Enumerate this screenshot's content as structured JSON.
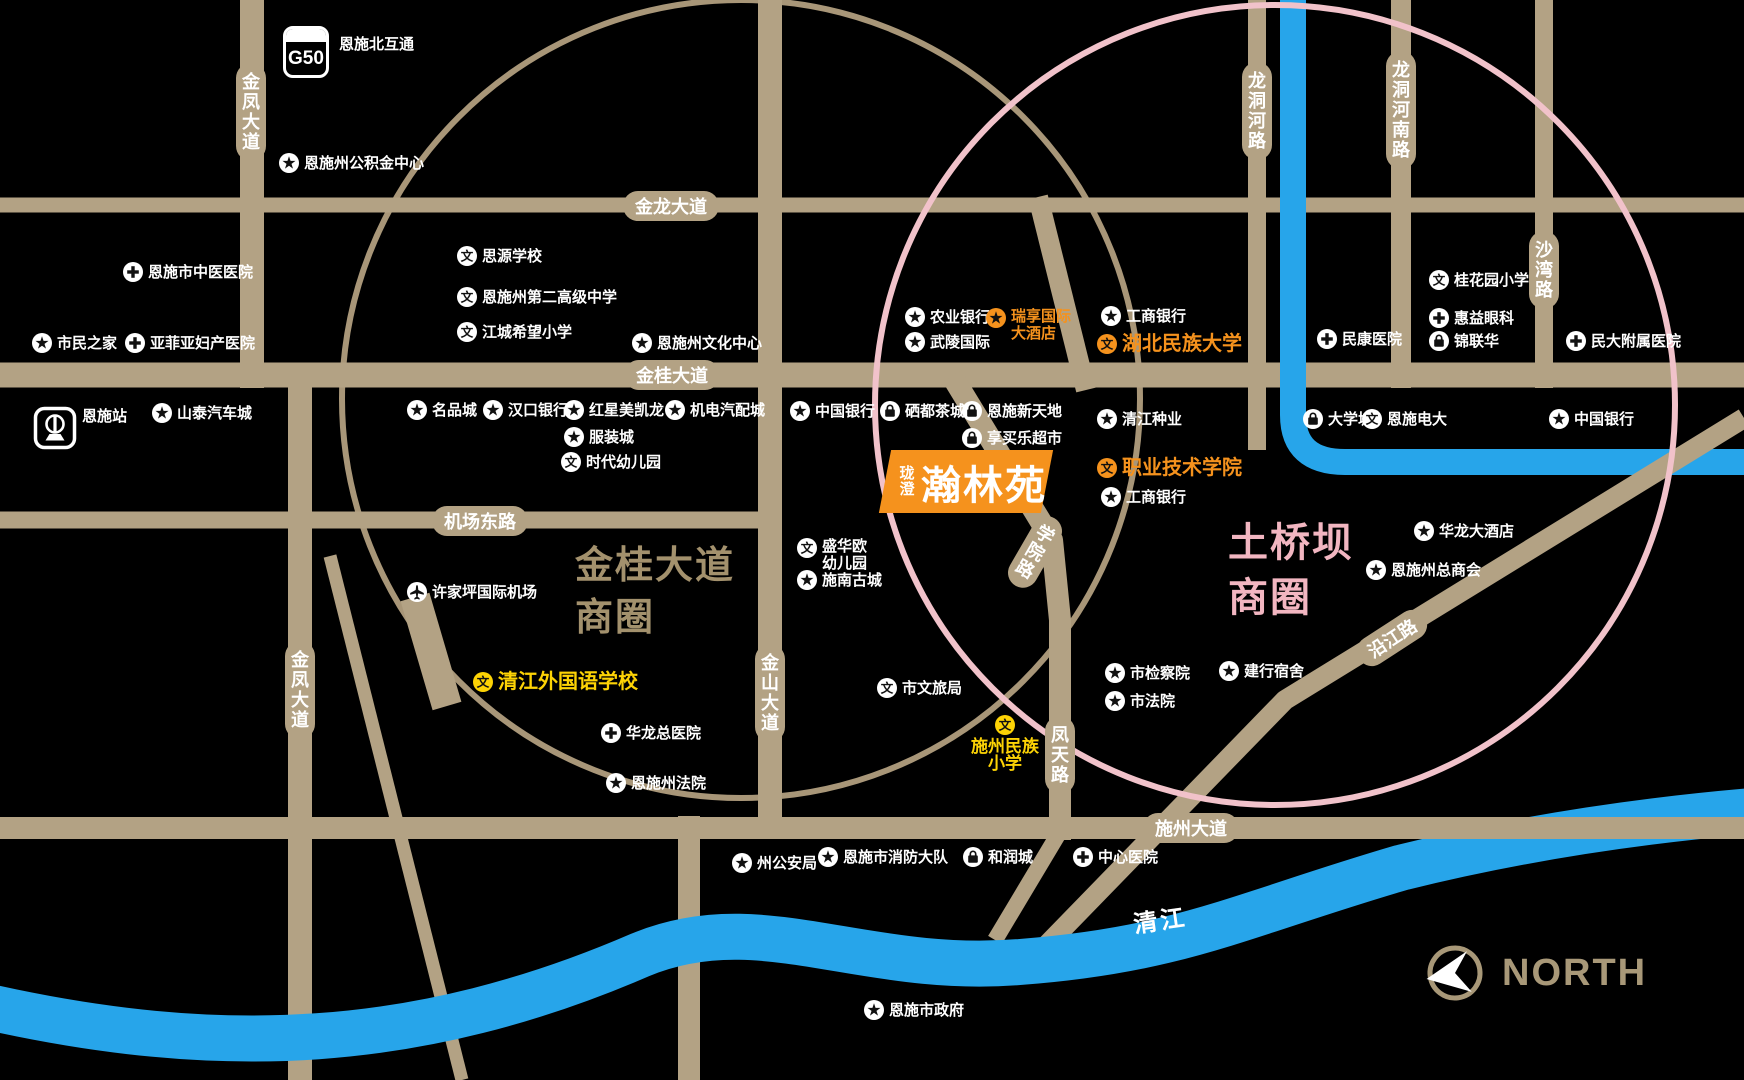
{
  "map": {
    "highway_badge": {
      "code": "G50",
      "label": "恩施北互通"
    },
    "compass": {
      "label": "NORTH"
    },
    "project": {
      "prefix": "珑澄",
      "name": "瀚林苑"
    },
    "river_label": "清江",
    "icons": {
      "school_glyph": "文"
    },
    "colors": {
      "road_tan": "#b3a284",
      "river_blue": "#27a5ea",
      "accent_orange": "#f5921d",
      "accent_yellow": "#fdd305",
      "circle_pink": "#f1c2ca",
      "circle_tan": "#a89678",
      "district_tan_text": "#a3916d",
      "district_pink_text": "#f2b6c1"
    },
    "districts": [
      {
        "lines": [
          "金桂大道",
          "商圈"
        ],
        "color": "#a3916d",
        "x": 575,
        "y": 540,
        "size": 38
      },
      {
        "lines": [
          "土桥坝",
          "商圈"
        ],
        "color": "#f2b6c1",
        "x": 1228,
        "y": 516,
        "size": 40
      }
    ],
    "road_labels": [
      {
        "text": "金龙大道",
        "x": 671,
        "y": 206,
        "dir": "h",
        "rot": 0
      },
      {
        "text": "金桂大道",
        "x": 672,
        "y": 375,
        "dir": "h",
        "rot": 0
      },
      {
        "text": "机场东路",
        "x": 480,
        "y": 521,
        "dir": "h",
        "rot": 0
      },
      {
        "text": "施州大道",
        "x": 1191,
        "y": 828,
        "dir": "h",
        "rot": 0
      },
      {
        "text": "金凤大道",
        "x": 251,
        "y": 112,
        "dir": "v",
        "rot": 0
      },
      {
        "text": "金凤大道",
        "x": 300,
        "y": 690,
        "dir": "v",
        "rot": 0
      },
      {
        "text": "金山大道",
        "x": 770,
        "y": 693,
        "dir": "v",
        "rot": 0
      },
      {
        "text": "龙洞河路",
        "x": 1257,
        "y": 111,
        "dir": "v",
        "rot": 0
      },
      {
        "text": "龙洞河南路",
        "x": 1401,
        "y": 110,
        "dir": "v",
        "rot": 0
      },
      {
        "text": "沙湾路",
        "x": 1544,
        "y": 270,
        "dir": "v",
        "rot": 0
      },
      {
        "text": "凤天路",
        "x": 1060,
        "y": 755,
        "dir": "v",
        "rot": 0
      },
      {
        "text": "学院路",
        "x": 1035,
        "y": 552,
        "dir": "v",
        "rot": 30
      },
      {
        "text": "沿江路",
        "x": 1392,
        "y": 638,
        "dir": "h",
        "rot": -33
      }
    ],
    "pois": [
      {
        "label": "恩施州公积金中心",
        "x": 289,
        "y": 163,
        "icon": "star",
        "tone": "white"
      },
      {
        "label": "恩施市中医医院",
        "x": 133,
        "y": 272,
        "icon": "hospital",
        "tone": "white"
      },
      {
        "label": "市民之家",
        "x": 42,
        "y": 343,
        "icon": "star",
        "tone": "white"
      },
      {
        "label": "亚菲亚妇产医院",
        "x": 135,
        "y": 343,
        "icon": "hospital",
        "tone": "white"
      },
      {
        "label": "恩施站",
        "x": 55,
        "y": 428,
        "icon": "train",
        "tone": "white",
        "variant": "train"
      },
      {
        "label": "山泰汽车城",
        "x": 162,
        "y": 413,
        "icon": "star",
        "tone": "white"
      },
      {
        "label": "思源学校",
        "x": 467,
        "y": 256,
        "icon": "school",
        "tone": "white"
      },
      {
        "label": "恩施州第二高级中学",
        "x": 467,
        "y": 297,
        "icon": "school",
        "tone": "white"
      },
      {
        "label": "江城希望小学",
        "x": 467,
        "y": 332,
        "icon": "school",
        "tone": "white"
      },
      {
        "label": "恩施州文化中心",
        "x": 642,
        "y": 343,
        "icon": "star",
        "tone": "white"
      },
      {
        "label": "名品城",
        "x": 417,
        "y": 410,
        "icon": "star",
        "tone": "white"
      },
      {
        "label": "汉口银行",
        "x": 493,
        "y": 410,
        "icon": "star",
        "tone": "white"
      },
      {
        "label": "红星美凯龙",
        "x": 574,
        "y": 410,
        "icon": "star",
        "tone": "white"
      },
      {
        "label": "机电汽配城",
        "x": 675,
        "y": 410,
        "icon": "star",
        "tone": "white"
      },
      {
        "label": "服装城",
        "x": 574,
        "y": 437,
        "icon": "star",
        "tone": "white"
      },
      {
        "label": "时代幼儿园",
        "x": 571,
        "y": 462,
        "icon": "school",
        "tone": "white"
      },
      {
        "label": "中国银行",
        "x": 800,
        "y": 411,
        "icon": "star",
        "tone": "white"
      },
      {
        "label": "硒都茶城",
        "x": 890,
        "y": 411,
        "icon": "bag",
        "tone": "white"
      },
      {
        "label": "恩施新天地",
        "x": 972,
        "y": 411,
        "icon": "bag",
        "tone": "white"
      },
      {
        "label": "享买乐超市",
        "x": 972,
        "y": 438,
        "icon": "bag",
        "tone": "white"
      },
      {
        "label": "农业银行",
        "x": 915,
        "y": 317,
        "icon": "star",
        "tone": "white"
      },
      {
        "label": "武陵国际",
        "x": 915,
        "y": 342,
        "icon": "star",
        "tone": "white"
      },
      {
        "label": "瑞享国际大酒店",
        "x": 996,
        "y": 318,
        "icon": "star",
        "tone": "orange",
        "lines": [
          "瑞享国际",
          "大酒店"
        ]
      },
      {
        "label": "工商银行",
        "x": 1111,
        "y": 316,
        "icon": "star",
        "tone": "white"
      },
      {
        "label": "湖北民族大学",
        "x": 1107,
        "y": 344,
        "icon": "school",
        "tone": "orange",
        "size": 20
      },
      {
        "label": "清江种业",
        "x": 1107,
        "y": 419,
        "icon": "star",
        "tone": "white"
      },
      {
        "label": "职业技术学院",
        "x": 1107,
        "y": 468,
        "icon": "school",
        "tone": "orange",
        "size": 20
      },
      {
        "label": "工商银行",
        "x": 1111,
        "y": 497,
        "icon": "star",
        "tone": "white"
      },
      {
        "label": "民康医院",
        "x": 1327,
        "y": 339,
        "icon": "hospital",
        "tone": "white"
      },
      {
        "label": "桂花园小学",
        "x": 1439,
        "y": 280,
        "icon": "school",
        "tone": "white"
      },
      {
        "label": "惠益眼科",
        "x": 1439,
        "y": 318,
        "icon": "hospital",
        "tone": "white"
      },
      {
        "label": "锦联华",
        "x": 1439,
        "y": 341,
        "icon": "bag",
        "tone": "white"
      },
      {
        "label": "民大附属医院",
        "x": 1576,
        "y": 341,
        "icon": "hospital",
        "tone": "white"
      },
      {
        "label": "大学城",
        "x": 1313,
        "y": 419,
        "icon": "bag",
        "tone": "white"
      },
      {
        "label": "恩施电大",
        "x": 1372,
        "y": 419,
        "icon": "school",
        "tone": "white"
      },
      {
        "label": "中国银行",
        "x": 1559,
        "y": 419,
        "icon": "star",
        "tone": "white"
      },
      {
        "label": "华龙大酒店",
        "x": 1424,
        "y": 531,
        "icon": "star",
        "tone": "white"
      },
      {
        "label": "恩施州总商会",
        "x": 1376,
        "y": 570,
        "icon": "star",
        "tone": "white"
      },
      {
        "label": "许家坪国际机场",
        "x": 417,
        "y": 592,
        "icon": "plane",
        "tone": "white"
      },
      {
        "label": "盛华欧幼儿园",
        "x": 807,
        "y": 548,
        "icon": "school",
        "tone": "white",
        "lines": [
          "盛华欧",
          "幼儿园"
        ]
      },
      {
        "label": "施南古城",
        "x": 807,
        "y": 580,
        "icon": "star",
        "tone": "white"
      },
      {
        "label": "清江外国语学校",
        "x": 483,
        "y": 682,
        "icon": "school",
        "tone": "yellow",
        "size": 20
      },
      {
        "label": "市文旅局",
        "x": 887,
        "y": 688,
        "icon": "school",
        "tone": "white"
      },
      {
        "label": "华龙总医院",
        "x": 611,
        "y": 733,
        "icon": "hospital",
        "tone": "white"
      },
      {
        "label": "恩施州法院",
        "x": 616,
        "y": 783,
        "icon": "star",
        "tone": "white"
      },
      {
        "label": "市检察院",
        "x": 1115,
        "y": 673,
        "icon": "star",
        "tone": "white"
      },
      {
        "label": "市法院",
        "x": 1115,
        "y": 701,
        "icon": "star",
        "tone": "white"
      },
      {
        "label": "建行宿舍",
        "x": 1229,
        "y": 671,
        "icon": "star",
        "tone": "white"
      },
      {
        "label": "施州民族小学",
        "x": 1005,
        "y": 725,
        "icon": "school",
        "tone": "yellow",
        "variant": "stack",
        "size": 17,
        "lines": [
          "施州民族",
          "小学"
        ]
      },
      {
        "label": "州公安局",
        "x": 742,
        "y": 863,
        "icon": "star",
        "tone": "white"
      },
      {
        "label": "恩施市消防大队",
        "x": 828,
        "y": 857,
        "icon": "star",
        "tone": "white"
      },
      {
        "label": "和润城",
        "x": 973,
        "y": 857,
        "icon": "bag",
        "tone": "white"
      },
      {
        "label": "中心医院",
        "x": 1083,
        "y": 857,
        "icon": "hospital",
        "tone": "white"
      },
      {
        "label": "恩施市政府",
        "x": 874,
        "y": 1010,
        "icon": "star",
        "tone": "white"
      }
    ]
  }
}
